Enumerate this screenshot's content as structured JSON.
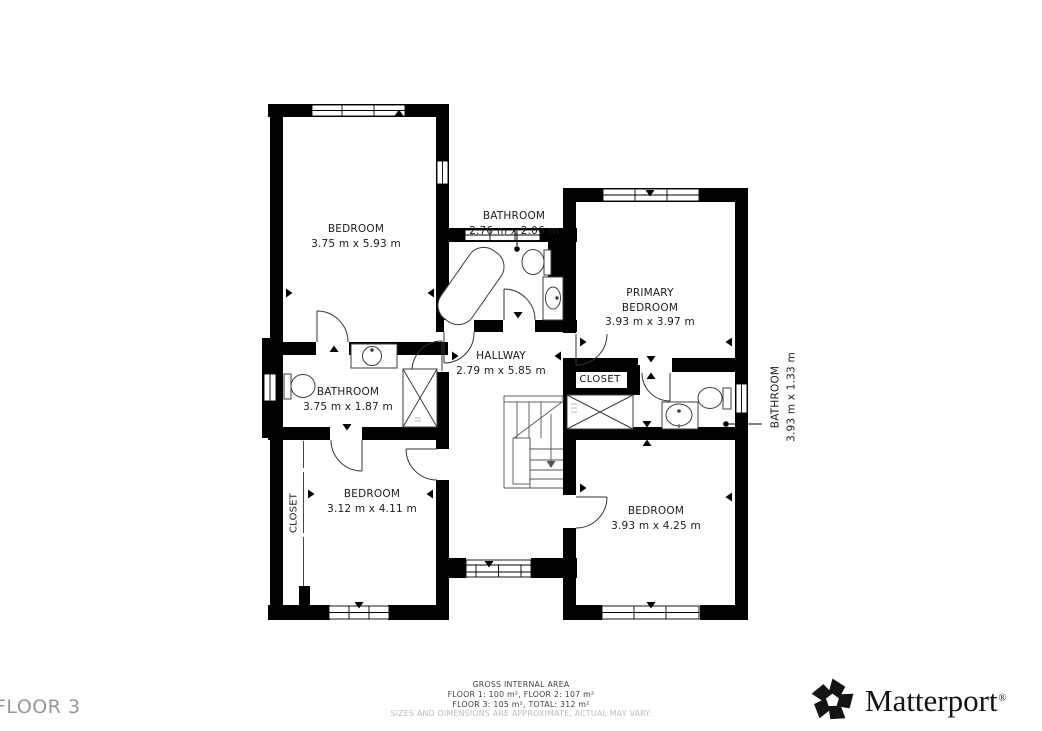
{
  "plan": {
    "rooms": {
      "bedroom_top_left": {
        "name": "BEDROOM",
        "dims": "3.75 m x 5.93 m"
      },
      "bathroom_top": {
        "name": "BATHROOM",
        "dims": "2.76 m x 2.06 m"
      },
      "primary_bedroom": {
        "name_line1": "PRIMARY",
        "name_line2": "BEDROOM",
        "dims": "3.93 m x 3.97 m"
      },
      "hallway": {
        "name": "HALLWAY",
        "dims": "2.79 m x 5.85 m"
      },
      "bathroom_left": {
        "name": "BATHROOM",
        "dims": "3.75 m x 1.87 m"
      },
      "bedroom_bottom_left": {
        "name": "BEDROOM",
        "dims": "3.12 m x 4.11 m"
      },
      "bedroom_bottom_right": {
        "name": "BEDROOM",
        "dims": "3.93 m x 4.25 m"
      },
      "bathroom_right": {
        "name": "BATHROOM",
        "dims": "3.93 m x 1.33 m"
      },
      "closet_right": {
        "name": "CLOSET"
      },
      "closet_left": {
        "name": "CLOSET"
      }
    },
    "colors": {
      "wall": "#000000",
      "floor": "#ffffff",
      "fixture_stroke": "#3d3d3d"
    }
  },
  "footer": {
    "floor_label": "FLOOR 3",
    "area_title": "GROSS INTERNAL AREA",
    "area_line1": "FLOOR 1: 100 m², FLOOR 2: 107 m²",
    "area_line2": "FLOOR 3: 105 m², TOTAL: 312 m²",
    "disclaimer": "SIZES AND DIMENSIONS ARE APPROXIMATE, ACTUAL MAY VARY."
  },
  "branding": {
    "logo_text": "Matterport",
    "registered_mark": "®",
    "logo_icon": "matterport-pinwheel-icon",
    "logo_color": "#141414"
  }
}
